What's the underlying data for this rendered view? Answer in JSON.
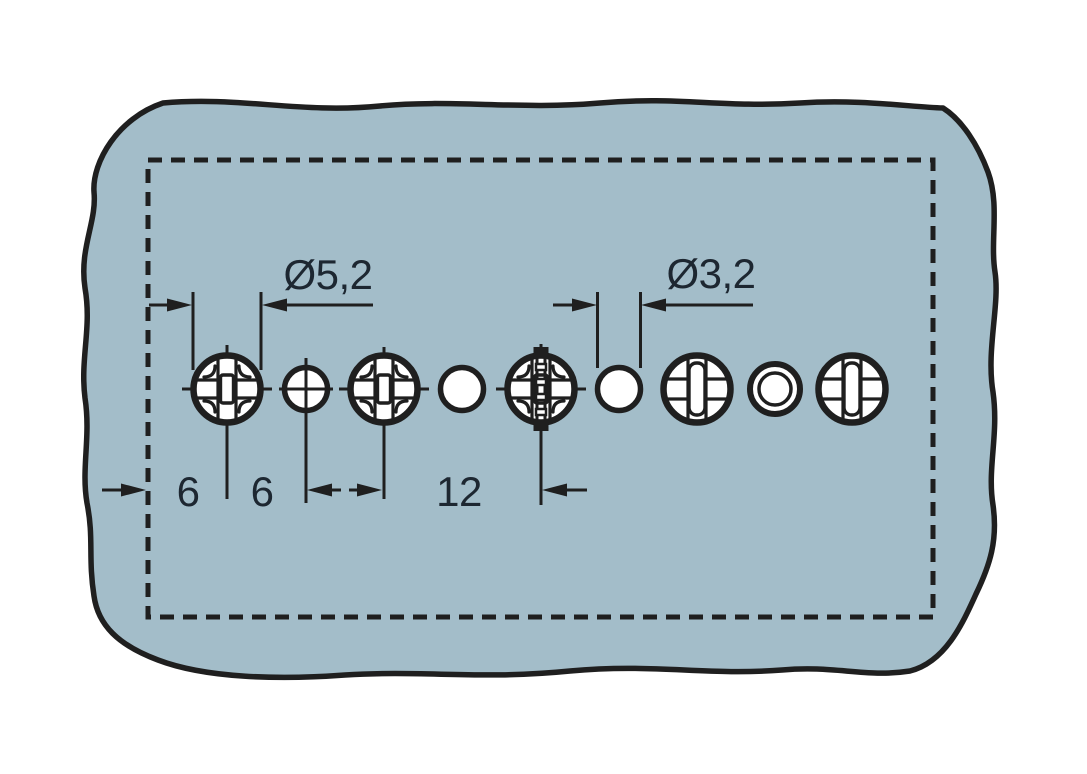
{
  "diagram": {
    "type": "drilling-plan",
    "description": "Drilling template for a mounting panel: row of nine holes inside a dashed cut-out outline on a torn-edge blue-grey panel",
    "colors": {
      "background": "#ffffff",
      "panel_fill": "#a3bdc9",
      "line": "#1f1f1f",
      "hole_fill": "#ffffff",
      "text": "#1d2731"
    },
    "labels": {
      "large_hole_diameter": "Ø5,2",
      "small_hole_diameter": "Ø3,2",
      "edge_distance": "6",
      "hole_pitch": "6",
      "double_pitch": "12"
    },
    "dimensions_mm": {
      "edge_to_first_hole": "6",
      "pitch_between_holes": "6",
      "double_pitch": "12",
      "large_hole_diameter": "5,2",
      "small_hole_diameter": "3,2"
    },
    "holes": [
      {
        "index": 1,
        "x": 227,
        "y": 389,
        "diameter": "5,2",
        "style": "cross-recess with centerlines"
      },
      {
        "index": 2,
        "x": 306,
        "y": 389,
        "diameter": "3,2",
        "style": "centerline cross"
      },
      {
        "index": 3,
        "x": 384,
        "y": 389,
        "diameter": "5,2",
        "style": "cross-recess with centerlines"
      },
      {
        "index": 4,
        "x": 462,
        "y": 389,
        "diameter": "3,2",
        "style": "plain"
      },
      {
        "index": 5,
        "x": 541,
        "y": 389,
        "diameter": "5,2",
        "style": "cross-recess with inserted screw"
      },
      {
        "index": 6,
        "x": 619,
        "y": 389,
        "diameter": "3,2",
        "style": "plain, dimension referenced"
      },
      {
        "index": 7,
        "x": 697,
        "y": 389,
        "diameter": "5,2",
        "style": "cross-recess"
      },
      {
        "index": 8,
        "x": 775,
        "y": 389,
        "diameter": "3,2",
        "style": "ring collar"
      },
      {
        "index": 9,
        "x": 852,
        "y": 389,
        "diameter": "5,2",
        "style": "cross-recess"
      }
    ]
  }
}
